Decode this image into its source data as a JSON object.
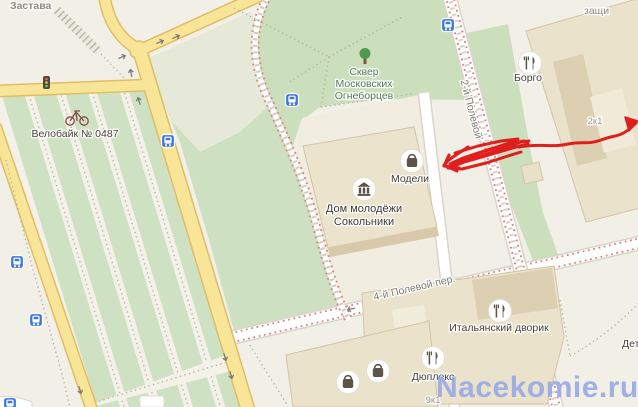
{
  "map": {
    "region_labels": {
      "district": "Застава",
      "protected_partial": "защи",
      "bottom_right_partial": "Дет"
    },
    "park": {
      "line1": "Сквер",
      "line2": "Московских",
      "line3": "Огнеборцев"
    },
    "streets": {
      "polevoy2": "2-й Полевой",
      "polevoy4": "4-й Полевой пер."
    },
    "pois": {
      "borgo": "Борго",
      "modeli": "Модели",
      "dom_line1": "Дом молодёжи",
      "dom_line2": "Сокольники",
      "italian": "Итальянский дворик",
      "duplex": "Дюплекс",
      "bike_station": "Велобайк № 0487"
    },
    "building_numbers": {
      "b2k1": "2к1",
      "b9k1": "9к1"
    },
    "watermark": "Nacekomie.ru",
    "colors": {
      "background": "#f2efe7",
      "road_yellow": "#f9e597",
      "road_casing": "#ddbe66",
      "park_green": "#cbdfbd",
      "pale_green": "#e6e9d8",
      "field_green": "#a6d29a",
      "building_fill": "#ebe2cb",
      "transit_blue": "#3f79da",
      "tram_red": "#dd8181",
      "scribble_red": "#e01414",
      "watermark_blue": "#98aae5"
    }
  }
}
